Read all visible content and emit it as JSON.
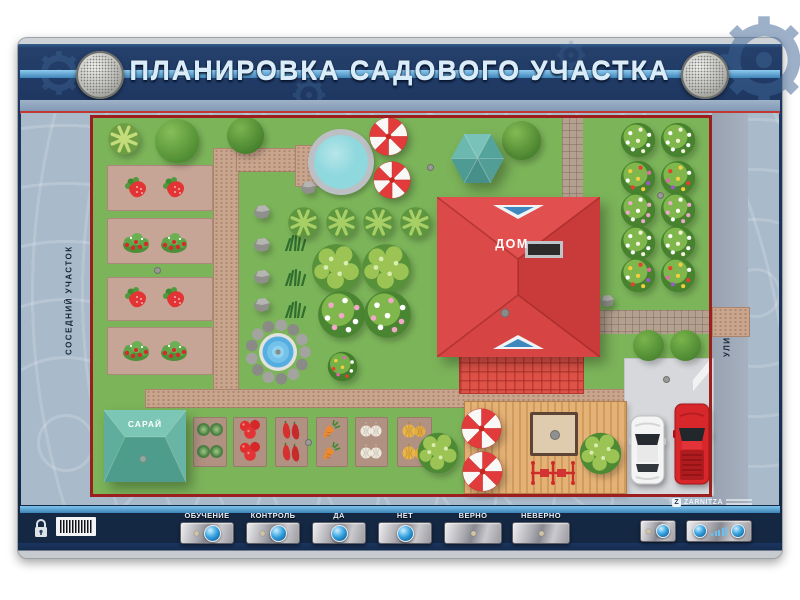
{
  "title": "ПЛАНИРОВКА САДОВОГО УЧАСТКА",
  "brand": "ZARNITZA",
  "map": {
    "labels": {
      "neighbor": "СОСЕДНИЙ УЧАСТОК",
      "street": "УЛИЦА",
      "house": "ДОМ",
      "shed": "САРАЙ"
    },
    "items": [
      {
        "t": "path",
        "n": "garden-path",
        "x": 213,
        "y": 148,
        "w": 24,
        "h": 248
      },
      {
        "t": "path",
        "n": "garden-path",
        "x": 236,
        "y": 148,
        "w": 62,
        "h": 22
      },
      {
        "t": "path",
        "n": "pond-platform",
        "x": 295,
        "y": 145,
        "w": 25,
        "h": 40
      },
      {
        "t": "path",
        "n": "garden-path",
        "x": 145,
        "y": 389,
        "w": 488,
        "h": 17
      },
      {
        "t": "pathg",
        "n": "paved-path",
        "x": 562,
        "y": 116,
        "w": 21,
        "h": 120
      },
      {
        "t": "pathg",
        "n": "paved-path",
        "x": 597,
        "y": 310,
        "w": 115,
        "h": 24
      },
      {
        "t": "path",
        "n": "street-crossing",
        "x": 712,
        "y": 307,
        "w": 36,
        "h": 28
      },
      {
        "t": "grido",
        "n": "patio-tiles",
        "x": 562,
        "y": 236,
        "w": 32,
        "h": 118
      },
      {
        "t": "gridr",
        "n": "terrace-tiles",
        "x": 459,
        "y": 352,
        "w": 123,
        "h": 40
      },
      {
        "t": "parking",
        "n": "parking-area",
        "x": 624,
        "y": 358,
        "w": 88,
        "h": 136
      },
      {
        "t": "gate",
        "n": "gate-opening",
        "x": 693,
        "y": 360,
        "w": 19,
        "h": 34
      },
      {
        "t": "deck",
        "n": "wooden-deck",
        "x": 464,
        "y": 401,
        "w": 161,
        "h": 91
      },
      {
        "t": "bed",
        "n": "strawberry-bed",
        "x": 107,
        "y": 165,
        "w": 106,
        "h": 46
      },
      {
        "t": "bed",
        "n": "strawberry-bed",
        "x": 107,
        "y": 218,
        "w": 106,
        "h": 46
      },
      {
        "t": "bed",
        "n": "strawberry-bed",
        "x": 107,
        "y": 277,
        "w": 106,
        "h": 44
      },
      {
        "t": "bed",
        "n": "strawberry-bed",
        "x": 107,
        "y": 327,
        "w": 106,
        "h": 48
      },
      {
        "t": "bed2",
        "n": "cabbage-bed",
        "x": 193,
        "y": 417,
        "w": 34,
        "h": 50
      },
      {
        "t": "bed2",
        "n": "tomato-bed",
        "x": 233,
        "y": 417,
        "w": 34,
        "h": 50
      },
      {
        "t": "bed2",
        "n": "pepper-bed",
        "x": 275,
        "y": 417,
        "w": 33,
        "h": 50
      },
      {
        "t": "bed2",
        "n": "carrot-bed",
        "x": 316,
        "y": 417,
        "w": 32,
        "h": 50
      },
      {
        "t": "bed2",
        "n": "garlic-bed",
        "x": 355,
        "y": 417,
        "w": 33,
        "h": 50
      },
      {
        "t": "bed2",
        "n": "onion-bed",
        "x": 397,
        "y": 417,
        "w": 35,
        "h": 50
      },
      {
        "t": "strawb",
        "n": "strawberry",
        "x": 124,
        "y": 176,
        "w": 26,
        "h": 25
      },
      {
        "t": "strawb",
        "n": "strawberry",
        "x": 162,
        "y": 176,
        "w": 26,
        "h": 25
      },
      {
        "t": "bbush",
        "n": "strawberry-bush",
        "x": 121,
        "y": 229,
        "w": 30,
        "h": 25
      },
      {
        "t": "bbush",
        "n": "strawberry-bush",
        "x": 159,
        "y": 229,
        "w": 30,
        "h": 25
      },
      {
        "t": "strawb",
        "n": "strawberry",
        "x": 124,
        "y": 286,
        "w": 26,
        "h": 25
      },
      {
        "t": "strawb",
        "n": "strawberry",
        "x": 162,
        "y": 286,
        "w": 26,
        "h": 25
      },
      {
        "t": "bbush",
        "n": "strawberry-bush",
        "x": 121,
        "y": 337,
        "w": 30,
        "h": 25
      },
      {
        "t": "bbush",
        "n": "strawberry-bush",
        "x": 159,
        "y": 337,
        "w": 30,
        "h": 25
      },
      {
        "t": "cabbage",
        "n": "cabbage",
        "x": 196,
        "y": 421,
        "w": 28,
        "h": 17
      },
      {
        "t": "cabbage",
        "n": "cabbage",
        "x": 196,
        "y": 443,
        "w": 28,
        "h": 17
      },
      {
        "t": "tomato",
        "n": "tomatoes",
        "x": 238,
        "y": 419,
        "w": 24,
        "h": 21
      },
      {
        "t": "tomato",
        "n": "tomatoes",
        "x": 238,
        "y": 441,
        "w": 24,
        "h": 21
      },
      {
        "t": "pepper",
        "n": "peppers",
        "x": 281,
        "y": 420,
        "w": 21,
        "h": 21
      },
      {
        "t": "pepper",
        "n": "peppers",
        "x": 281,
        "y": 442,
        "w": 21,
        "h": 21
      },
      {
        "t": "carrot",
        "n": "carrot",
        "x": 321,
        "y": 419,
        "w": 22,
        "h": 21
      },
      {
        "t": "carrot",
        "n": "carrot",
        "x": 321,
        "y": 441,
        "w": 22,
        "h": 21
      },
      {
        "t": "garlic",
        "n": "garlic",
        "x": 359,
        "y": 421,
        "w": 24,
        "h": 18
      },
      {
        "t": "garlic",
        "n": "garlic",
        "x": 359,
        "y": 443,
        "w": 24,
        "h": 18
      },
      {
        "t": "onion",
        "n": "onions",
        "x": 401,
        "y": 420,
        "w": 26,
        "h": 19
      },
      {
        "t": "onion",
        "n": "onions",
        "x": 401,
        "y": 442,
        "w": 26,
        "h": 19
      },
      {
        "t": "palm",
        "n": "tree",
        "x": 107,
        "y": 122,
        "w": 34,
        "h": 34,
        "c": [
          "#C4DC7A",
          "#6E9E44"
        ]
      },
      {
        "t": "tree",
        "n": "tree",
        "x": 155,
        "y": 119,
        "w": 44,
        "h": 44,
        "c": [
          "#86BE58",
          "#4C8A30"
        ]
      },
      {
        "t": "tree",
        "n": "tree",
        "x": 227,
        "y": 117,
        "w": 37,
        "h": 37,
        "c": [
          "#7AB450",
          "#447E2A"
        ]
      },
      {
        "t": "tree",
        "n": "tree",
        "x": 502,
        "y": 121,
        "w": 39,
        "h": 39,
        "c": [
          "#82BA54",
          "#47802C"
        ]
      },
      {
        "t": "rock",
        "n": "rock",
        "x": 300,
        "y": 180,
        "w": 17,
        "h": 15
      },
      {
        "t": "rock",
        "n": "rock",
        "x": 253,
        "y": 204,
        "w": 18,
        "h": 16
      },
      {
        "t": "rock",
        "n": "rock",
        "x": 253,
        "y": 237,
        "w": 18,
        "h": 16
      },
      {
        "t": "rock",
        "n": "rock",
        "x": 253,
        "y": 269,
        "w": 18,
        "h": 16
      },
      {
        "t": "rock",
        "n": "rock",
        "x": 253,
        "y": 297,
        "w": 18,
        "h": 16
      },
      {
        "t": "grass",
        "n": "grass-tuft",
        "x": 284,
        "y": 234,
        "w": 23,
        "h": 17
      },
      {
        "t": "grass",
        "n": "grass-tuft",
        "x": 284,
        "y": 269,
        "w": 23,
        "h": 17
      },
      {
        "t": "grass",
        "n": "grass-tuft",
        "x": 284,
        "y": 301,
        "w": 23,
        "h": 17
      },
      {
        "t": "palm",
        "n": "tree",
        "x": 287,
        "y": 206,
        "w": 33,
        "h": 33,
        "c": [
          "#A8CE66",
          "#5E9640"
        ]
      },
      {
        "t": "palm",
        "n": "tree",
        "x": 325,
        "y": 206,
        "w": 33,
        "h": 33,
        "c": [
          "#A8CE66",
          "#5E9640"
        ]
      },
      {
        "t": "palm",
        "n": "tree",
        "x": 362,
        "y": 206,
        "w": 33,
        "h": 33,
        "c": [
          "#A8CE66",
          "#5E9640"
        ]
      },
      {
        "t": "palm",
        "n": "tree",
        "x": 399,
        "y": 206,
        "w": 33,
        "h": 33,
        "c": [
          "#A8CE66",
          "#5E9640"
        ]
      },
      {
        "t": "clump",
        "n": "fruit-tree",
        "x": 310,
        "y": 242,
        "w": 53,
        "h": 53,
        "c": [
          "#9CC455",
          "#57913A"
        ]
      },
      {
        "t": "clump",
        "n": "fruit-tree",
        "x": 360,
        "y": 242,
        "w": 53,
        "h": 53,
        "c": [
          "#9CC455",
          "#57913A"
        ]
      },
      {
        "t": "fbush",
        "n": "flower-bush",
        "x": 317,
        "y": 290,
        "w": 49,
        "h": 49,
        "c": [
          "#7FB74D",
          "#4A8531"
        ],
        "d": [
          "#F2A8C8",
          "#FFFFFF",
          "#F2A8C8",
          "#FFFFFF",
          "#F2A8C8",
          "#FFFFFF",
          "#F2A8C8",
          "#FFFFFF"
        ]
      },
      {
        "t": "fbush",
        "n": "flower-bush",
        "x": 363,
        "y": 290,
        "w": 49,
        "h": 49,
        "c": [
          "#7FB74D",
          "#4A8531"
        ],
        "d": [
          "#FFFFFF",
          "#F2A8C8",
          "#FFFFFF",
          "#F2A8C8",
          "#FFFFFF",
          "#F2A8C8",
          "#FFFFFF",
          "#F2A8C8"
        ]
      },
      {
        "t": "fbush",
        "n": "flower-bush",
        "x": 327,
        "y": 351,
        "w": 31,
        "h": 31,
        "c": [
          "#74B148",
          "#427E2B"
        ],
        "d": [
          "#F5CE3E",
          "#E06AA8",
          "#FFFFFF",
          "#E8402E",
          "#F5CE3E",
          "#FFFFFF",
          "#E06AA8",
          "#E8402E"
        ]
      },
      {
        "t": "fbush",
        "n": "flower-bush",
        "x": 620,
        "y": 122,
        "w": 36,
        "h": 36,
        "c": [
          "#7FB74D",
          "#47822E"
        ],
        "d": [
          "#FFFFFF",
          "#F5F0D8",
          "#FFFFFF",
          "#FFFFFF",
          "#F5F0D8",
          "#FFFFFF",
          "#FFFFFF",
          "#F5F0D8"
        ]
      },
      {
        "t": "fbush",
        "n": "flower-bush",
        "x": 660,
        "y": 122,
        "w": 36,
        "h": 36,
        "c": [
          "#7FB74D",
          "#47822E"
        ],
        "d": [
          "#FFFFFF",
          "#F5F0D8",
          "#FFFFFF",
          "#FFFFFF",
          "#F5F0D8",
          "#FFFFFF",
          "#FFFFFF",
          "#F5F0D8"
        ]
      },
      {
        "t": "fbush",
        "n": "flower-bush",
        "x": 620,
        "y": 160,
        "w": 36,
        "h": 36,
        "c": [
          "#7FB74D",
          "#47822E"
        ],
        "d": [
          "#F5CE3E",
          "#E8402E",
          "#E06AA8",
          "#FFFFFF",
          "#F5CE3E",
          "#9C59C9",
          "#E8402E",
          "#F5CE3E"
        ]
      },
      {
        "t": "fbush",
        "n": "flower-bush",
        "x": 660,
        "y": 160,
        "w": 36,
        "h": 36,
        "c": [
          "#7FB74D",
          "#47822E"
        ],
        "d": [
          "#E8402E",
          "#F5CE3E",
          "#FFFFFF",
          "#E06AA8",
          "#F5CE3E",
          "#E8402E",
          "#9C59C9",
          "#F5CE3E"
        ]
      },
      {
        "t": "fbush",
        "n": "flower-bush",
        "x": 620,
        "y": 192,
        "w": 36,
        "h": 36,
        "c": [
          "#7FB74D",
          "#47822E"
        ],
        "d": [
          "#EFA8CC",
          "#FFFFFF",
          "#EFA8CC",
          "#EFA8CC",
          "#FFFFFF",
          "#EFA8CC",
          "#FFFFFF",
          "#EFA8CC"
        ]
      },
      {
        "t": "fbush",
        "n": "flower-bush",
        "x": 660,
        "y": 192,
        "w": 36,
        "h": 36,
        "c": [
          "#7FB74D",
          "#47822E"
        ],
        "d": [
          "#EFA8CC",
          "#FFFFFF",
          "#EFA8CC",
          "#EFA8CC",
          "#FFFFFF",
          "#EFA8CC",
          "#FFFFFF",
          "#EFA8CC"
        ]
      },
      {
        "t": "fbush",
        "n": "flower-bush",
        "x": 620,
        "y": 225,
        "w": 36,
        "h": 36,
        "c": [
          "#7FB74D",
          "#47822E"
        ],
        "d": [
          "#FFFFFF",
          "#F5F0D8",
          "#FFFFFF",
          "#FFFFFF",
          "#F5F0D8",
          "#FFFFFF",
          "#FFFFFF",
          "#F5F0D8"
        ]
      },
      {
        "t": "fbush",
        "n": "flower-bush",
        "x": 660,
        "y": 225,
        "w": 36,
        "h": 36,
        "c": [
          "#7FB74D",
          "#47822E"
        ],
        "d": [
          "#FFFFFF",
          "#F5F0D8",
          "#FFFFFF",
          "#FFFFFF",
          "#F5F0D8",
          "#FFFFFF",
          "#FFFFFF",
          "#F5F0D8"
        ]
      },
      {
        "t": "fbush",
        "n": "flower-bush",
        "x": 620,
        "y": 257,
        "w": 36,
        "h": 36,
        "c": [
          "#7FB74D",
          "#47822E"
        ],
        "d": [
          "#F5CE3E",
          "#E8402E",
          "#E06AA8",
          "#FFFFFF",
          "#F5CE3E",
          "#9C59C9",
          "#E8402E",
          "#F5CE3E"
        ]
      },
      {
        "t": "fbush",
        "n": "flower-bush",
        "x": 660,
        "y": 257,
        "w": 36,
        "h": 36,
        "c": [
          "#7FB74D",
          "#47822E"
        ],
        "d": [
          "#E8402E",
          "#F5CE3E",
          "#FFFFFF",
          "#E06AA8",
          "#F5CE3E",
          "#E8402E",
          "#9C59C9",
          "#F5CE3E"
        ]
      },
      {
        "t": "rock",
        "n": "rock",
        "x": 599,
        "y": 294,
        "w": 16,
        "h": 14
      },
      {
        "t": "tree",
        "n": "tree",
        "x": 633,
        "y": 330,
        "w": 31,
        "h": 31,
        "c": [
          "#79B44C",
          "#4A8530"
        ]
      },
      {
        "t": "tree",
        "n": "tree",
        "x": 670,
        "y": 330,
        "w": 31,
        "h": 31,
        "c": [
          "#79B44C",
          "#4A8530"
        ]
      },
      {
        "t": "pond",
        "n": "pond",
        "x": 308,
        "y": 129,
        "w": 66,
        "h": 66
      },
      {
        "t": "umb",
        "n": "parasol",
        "x": 368,
        "y": 116,
        "w": 41,
        "h": 41
      },
      {
        "t": "umb",
        "n": "parasol",
        "x": 372,
        "y": 160,
        "w": 40,
        "h": 40
      },
      {
        "t": "gazebo",
        "n": "gazebo",
        "x": 450,
        "y": 133,
        "w": 55,
        "h": 51
      },
      {
        "t": "fountain",
        "n": "fountain",
        "x": 244,
        "y": 318,
        "w": 68,
        "h": 68
      },
      {
        "t": "house",
        "n": "house",
        "x": 437,
        "y": 197,
        "w": 163,
        "h": 160
      },
      {
        "t": "shed",
        "n": "shed",
        "x": 103,
        "y": 407,
        "w": 84,
        "h": 78
      },
      {
        "t": "clump",
        "n": "tree",
        "x": 416,
        "y": 431,
        "w": 44,
        "h": 44,
        "c": [
          "#9CC455",
          "#4E8A34"
        ]
      },
      {
        "t": "umb",
        "n": "parasol",
        "x": 460,
        "y": 407,
        "w": 43,
        "h": 43
      },
      {
        "t": "umb",
        "n": "parasol",
        "x": 461,
        "y": 450,
        "w": 43,
        "h": 43
      },
      {
        "t": "table",
        "n": "garden-table",
        "x": 530,
        "y": 412,
        "w": 48,
        "h": 44
      },
      {
        "t": "swing",
        "n": "swing-bench",
        "x": 528,
        "y": 459,
        "w": 50,
        "h": 27
      },
      {
        "t": "clump",
        "n": "tree",
        "x": 578,
        "y": 431,
        "w": 45,
        "h": 45,
        "c": [
          "#9CC455",
          "#4E8A34"
        ]
      },
      {
        "t": "car",
        "n": "car-white",
        "x": 629,
        "y": 414,
        "w": 37,
        "h": 72
      },
      {
        "t": "carr",
        "n": "car-red",
        "x": 673,
        "y": 402,
        "w": 38,
        "h": 84
      },
      {
        "t": "dot",
        "n": "led-marker",
        "x": 154,
        "y": 267,
        "w": 7,
        "h": 7
      },
      {
        "t": "dot",
        "n": "led-marker",
        "x": 305,
        "y": 439,
        "w": 7,
        "h": 7
      },
      {
        "t": "dot",
        "n": "led-marker",
        "x": 427,
        "y": 164,
        "w": 7,
        "h": 7
      },
      {
        "t": "dot",
        "n": "led-marker",
        "x": 657,
        "y": 192,
        "w": 7,
        "h": 7
      },
      {
        "t": "dot",
        "n": "led-marker",
        "x": 663,
        "y": 376,
        "w": 7,
        "h": 7
      }
    ]
  },
  "controls": {
    "buttons": [
      {
        "label": "ОБУЧЕНИЕ",
        "kind": "led-button"
      },
      {
        "label": "КОНТРОЛЬ",
        "kind": "led-button"
      },
      {
        "label": "ДА",
        "kind": "button"
      },
      {
        "label": "НЕТ",
        "kind": "button"
      },
      {
        "label": "ВЕРНО",
        "kind": "indicator"
      },
      {
        "label": "НЕВЕРНО",
        "kind": "indicator"
      }
    ],
    "volume_bars": 5
  },
  "hardware": {
    "speakers": [
      "left",
      "right"
    ],
    "lock_icon": "padlock",
    "barcode": true,
    "power_control": {
      "led": true,
      "button": true
    },
    "volume_control": {
      "buttons": 2,
      "bars": 5
    }
  },
  "colors": {
    "board": "#1B3254",
    "accent_stripe": "#5FA8D8",
    "lawn": "#7CB45A",
    "fence": "#9C1E1E",
    "house_roof": "#DC4242",
    "shed_roof": "#59ADA0",
    "path": "#C9A58E",
    "street": "#9EA8B6",
    "blueprint": "#A9BACB",
    "button_blue": "#2E9BD6"
  }
}
